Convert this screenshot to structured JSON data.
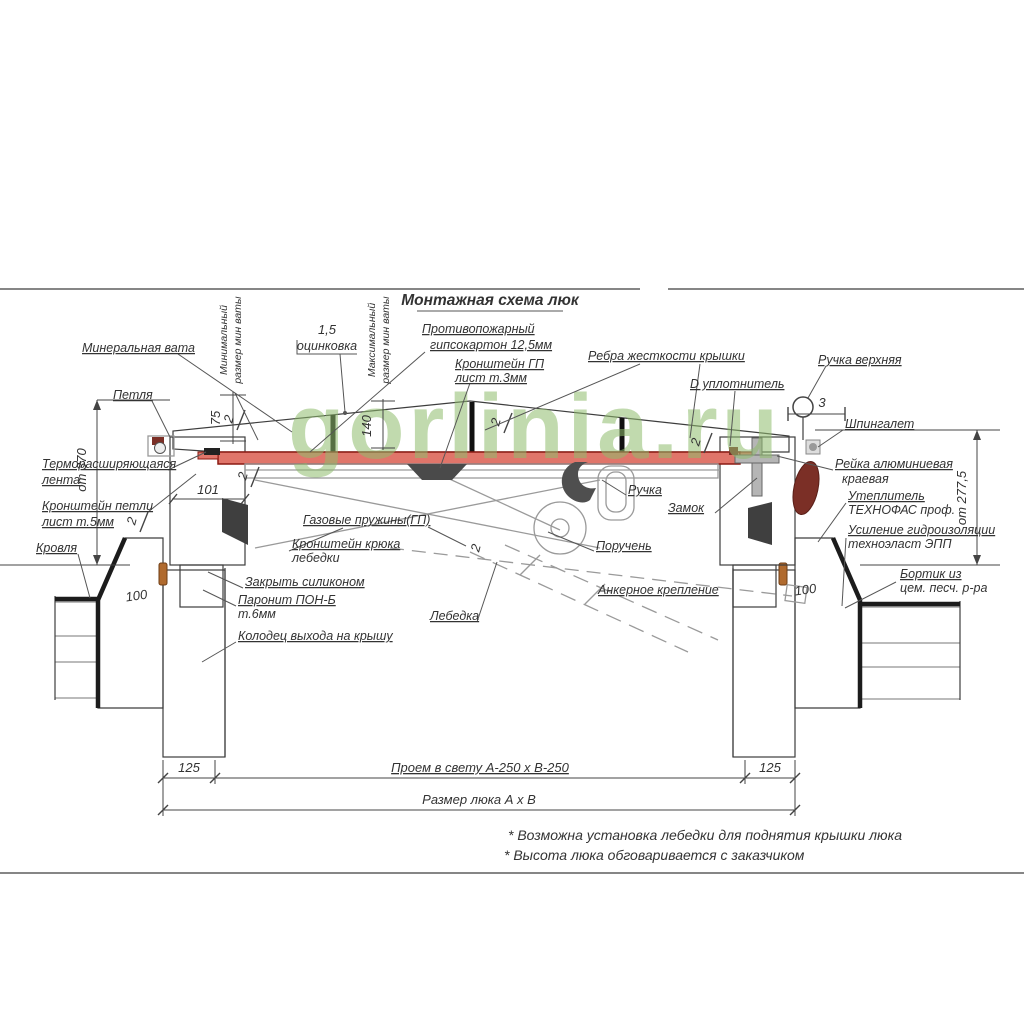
{
  "title": "Монтажная схема люк",
  "watermark": "gorlinia.ru",
  "labels": {
    "mineral_wool": "Минеральная вата",
    "min_wool_1": "Минимальный",
    "min_wool_2": "размер мин ваты",
    "max_wool_1": "Максимальный",
    "max_wool_2": "размер мин ваты",
    "galv_value": "1,5",
    "galv": "оцинковка",
    "fireproof_1": "Противопожарный",
    "fireproof_2": "гипсокартон 12,5мм",
    "bracket_gp_1": "Кронштейн ГП",
    "bracket_gp_2": "лист т.3мм",
    "ribs": "Ребра жесткости крышки",
    "seal": "D уплотнитель",
    "handle_top": "Ручка верхняя",
    "latch": "Шпингалет",
    "hinge": "Петля",
    "thermo_1": "Терморасширяющаяся",
    "thermo_2": "лента",
    "hinge_bracket_1": "Кронштейн петли",
    "hinge_bracket_2": "лист т.5мм",
    "roofing": "Кровля",
    "rail_1": "Рейка алюминиевая",
    "rail_2": "краевая",
    "insul_1": "Утеплитель",
    "insul_2": "ТЕХНОФАС проф.",
    "waterproof_1": "Усиление гидроизоляции",
    "waterproof_2": "техноэласт ЭПП",
    "curb_1": "Бортик из",
    "curb_2": "цем. песч. р-ра",
    "handle": "Ручка",
    "lock": "Замок",
    "gas_springs": "Газовые пружины(ГП)",
    "winch_bracket_1": "Кронштейн крюка",
    "winch_bracket_2": "лебедки",
    "handrail": "Поручень",
    "silicone": "Закрыть силиконом",
    "paronite_1": "Паронит ПОН-Б",
    "paronite_2": "т.6мм",
    "well": "Колодец выхода на крышу",
    "winch": "Лебедка",
    "anchor": "Анкерное крепление"
  },
  "dims": {
    "left_height": "от 370",
    "right_height": "от 277,5",
    "d75": "75",
    "d140": "140",
    "d101": "101",
    "d100": "100",
    "d2": "2",
    "d3": "3",
    "d125": "125",
    "clear_opening": "Проем в свету А-250 х В-250",
    "hatch_size": "Размер люка А х В"
  },
  "notes": {
    "note1": "* Возможна установка лебедки для поднятия крышки люка",
    "note2": "* Высота люка обговаривается с заказчиком"
  },
  "colors": {
    "insulation": "#dbee90",
    "drywall_red": "#e0756a",
    "drywall_border": "#8b1a12",
    "handle_brown": "#7b2f26",
    "watermark_green": "#8fbc6d",
    "line": "#3d3d3d"
  }
}
